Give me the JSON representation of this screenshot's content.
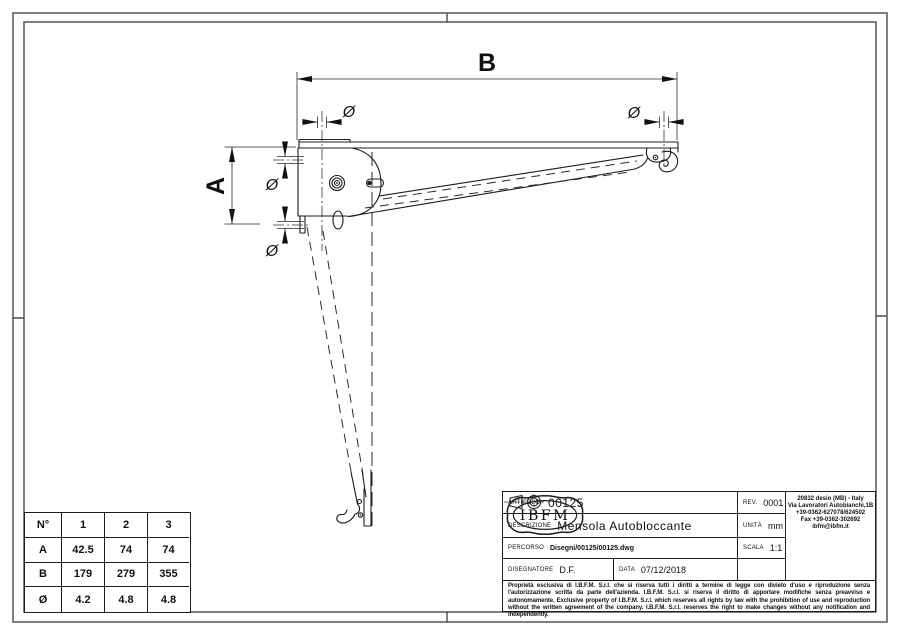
{
  "drawing": {
    "labels": {
      "dim_b": "B",
      "dim_a": "A",
      "diameter": "Ø"
    }
  },
  "size_table": {
    "header": {
      "col0": "N°",
      "col1": "1",
      "col2": "2",
      "col3": "3"
    },
    "rows": [
      {
        "label": "A",
        "v1": "42.5",
        "v2": "74",
        "v3": "74"
      },
      {
        "label": "B",
        "v1": "179",
        "v2": "279",
        "v3": "355"
      },
      {
        "label": "Ø",
        "v1": "4.2",
        "v2": "4.8",
        "v3": "4.8"
      }
    ]
  },
  "title_block": {
    "articolo_label": "ARTICOLO.",
    "articolo": "00125",
    "rev_label": "REV.",
    "rev": "0001",
    "descrizione_label": "DESCRIZIONE",
    "descrizione": "Mensola Autobloccante",
    "unita_label": "UNITÀ",
    "unita": "mm",
    "percorso_label": "PERCORSO",
    "percorso": "Disegni/00125/00125.dwg",
    "scala_label": "SCALA",
    "scala": "1:1",
    "disegnatore_label": "DISEGNATORE",
    "disegnatore": "D.F.",
    "data_label": "DATA",
    "data": "07/12/2018",
    "legal": "Proprietà esclusiva di I.B.F.M. S.r.l. che si riserva tutti i diritti a termine di legge con divieto d'uso e riproduzione senza l'autorizzazione scritta da parte dell'azienda. I.B.F.M. S.r.l. si riserva il diritto di apportare modifiche senza preavviso e autonomamente. Exclusive property of I.B.F.M. S.r.l. which reserves all rights by law with the prohibition of use and reproduction without the written agreement of the company. I.B.F.M. S.r.l. reserves the right to make changes without any notification and independently."
  },
  "logo": {
    "name": "IBFM",
    "address_lines": [
      "20832 desio (MB) - Italy",
      "Via Lavoratori Autobianchi,1B",
      "+39-0362-627078/624502",
      "Fax +39-0362-302692",
      "ibfm@ibfm.it"
    ]
  }
}
